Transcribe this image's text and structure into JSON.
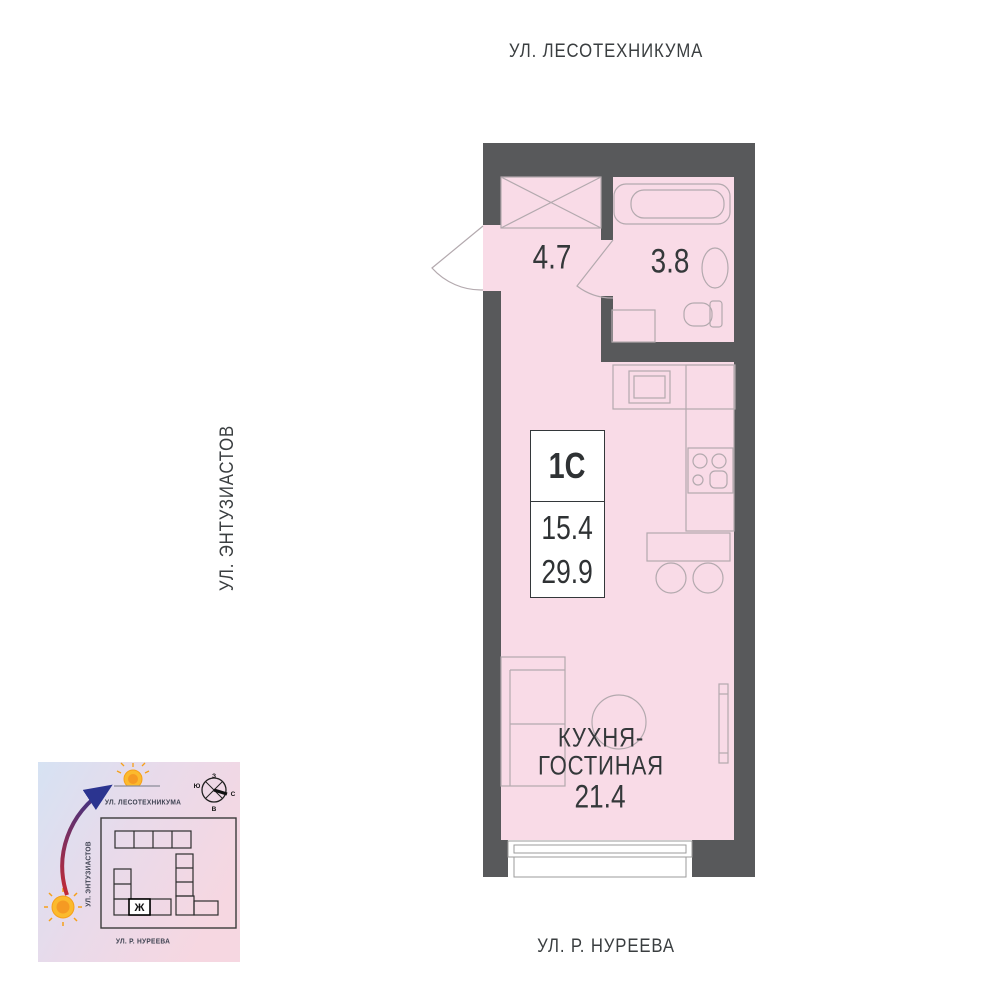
{
  "streets": {
    "top": "УЛ. ЛЕСОТЕХНИКУМА",
    "left": "УЛ. ЭНТУЗИАСТОВ",
    "bottom": "УЛ. Р. НУРЕЕВА"
  },
  "plan": {
    "rooms": {
      "hallway": {
        "area": "4.7"
      },
      "bathroom": {
        "area": "3.8"
      },
      "kitchen_living": {
        "name_line1": "КУХНЯ-",
        "name_line2": "ГОСТИНАЯ",
        "area": "21.4"
      }
    },
    "info_box": {
      "unit_type": "1С",
      "living_area": "15.4",
      "total_area": "29.9"
    },
    "colors": {
      "wall": "#58595B",
      "room_fill": "#F9DBE7",
      "furniture_line": "#B3A9AE",
      "text": "#34383A"
    }
  },
  "minimap": {
    "streets": {
      "top": "УЛ. ЛЕСОТЕХНИКУМА",
      "left": "УЛ. ЭНТУЗИАСТОВ",
      "bottom": "УЛ. Р. НУРЕЕВА"
    },
    "building_mark": "Ж",
    "compass": {
      "top": "З",
      "right": "С",
      "bottom": "В",
      "left": "Ю"
    },
    "colors": {
      "sun": "#FBBA2D",
      "arrow_start": "#C22A35",
      "arrow_end": "#2B3490"
    }
  }
}
